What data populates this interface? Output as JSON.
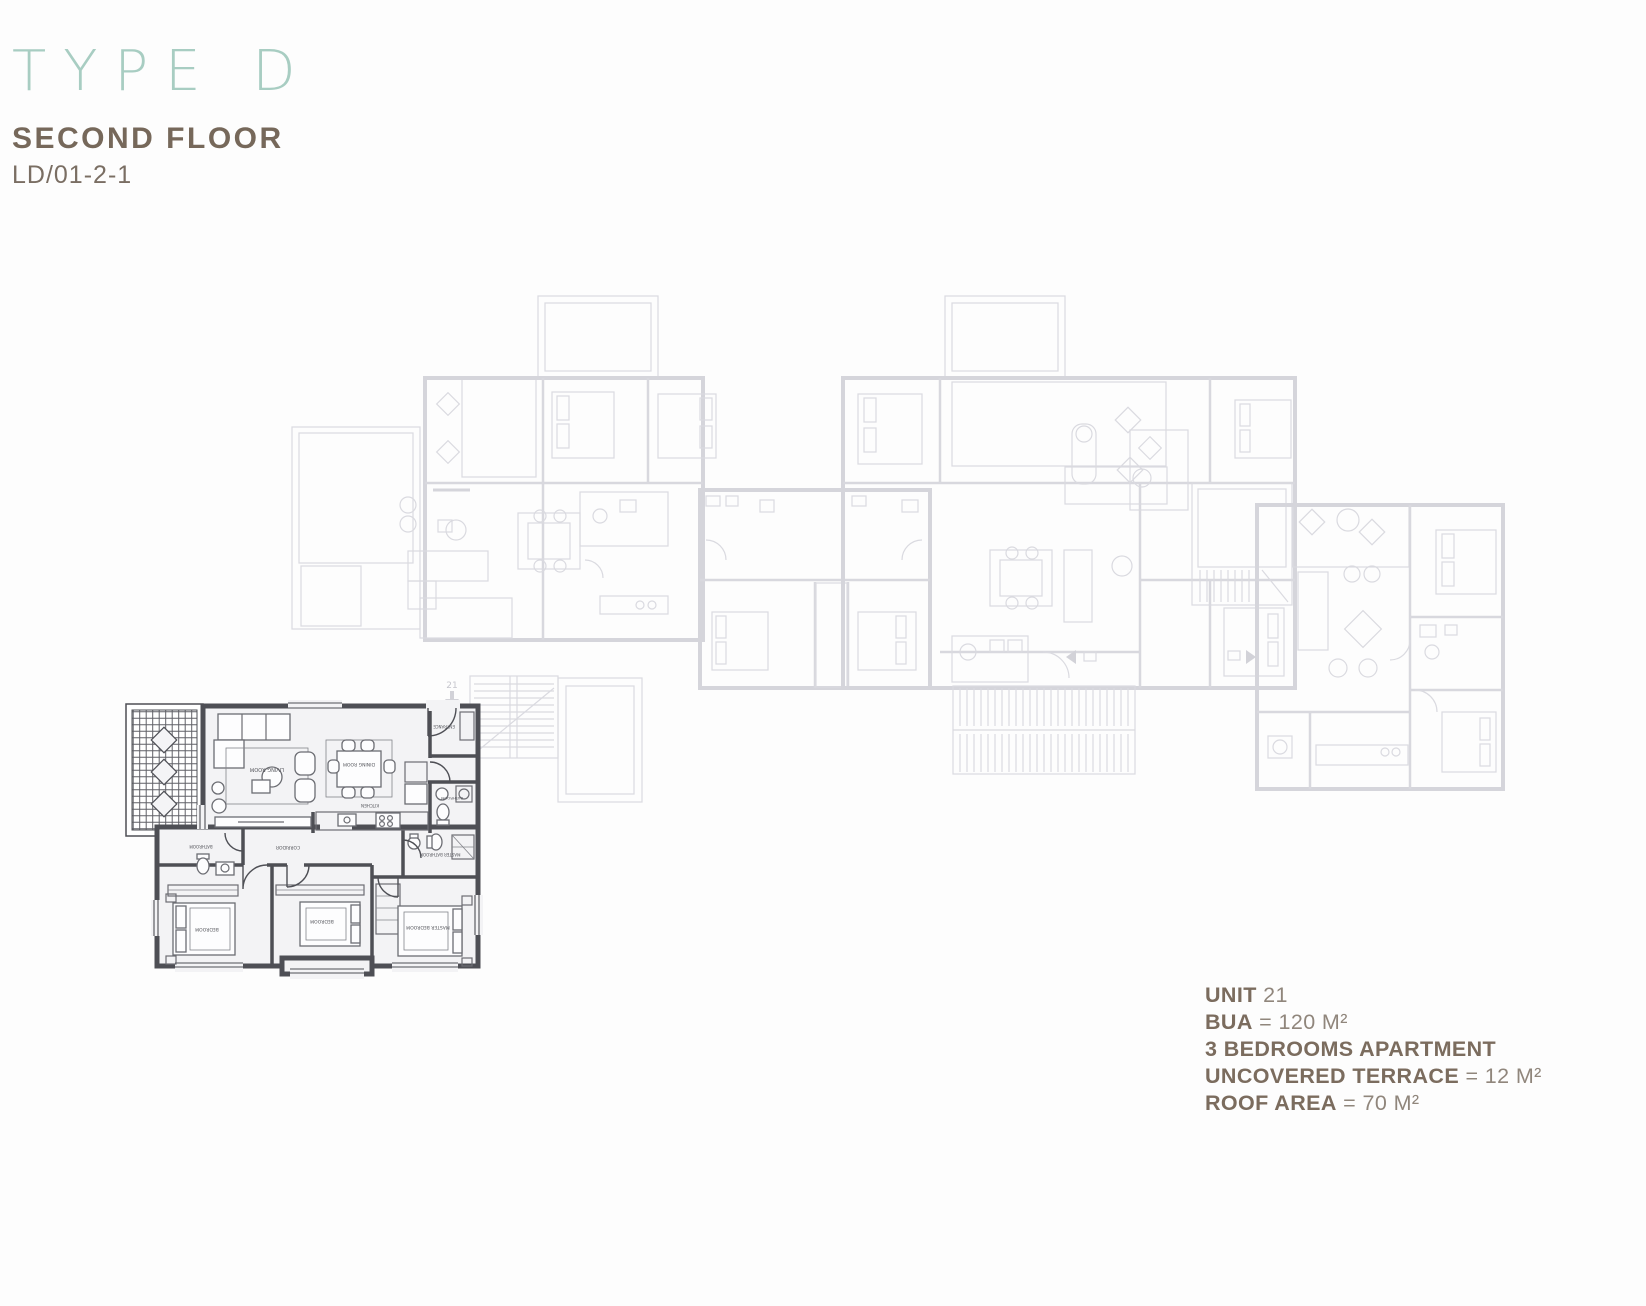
{
  "header": {
    "type_label": "TYPE D",
    "floor_label": "SECOND FLOOR",
    "code": "LD/01-2-1"
  },
  "unit_info": {
    "lines": [
      {
        "bold": "UNIT",
        "rest": " 21"
      },
      {
        "bold": "BUA",
        "rest": " = 120 M²"
      },
      {
        "bold": "3 BEDROOMS APARTMENT",
        "rest": ""
      },
      {
        "bold": "UNCOVERED TERRACE",
        "rest": " = 12 M²"
      },
      {
        "bold": "ROOF AREA",
        "rest": " = 70 M²"
      }
    ]
  },
  "plan": {
    "unit_marker": "21",
    "rooms": {
      "living": "LIVING ROOM",
      "dining": "DINING ROOM",
      "kitchen": "KITCHEN",
      "entrance": "ENTRANCE",
      "corridor": "CORRIDOR",
      "bathroom": "BATHROOM",
      "master_bathroom": "MASTER BATHROOM",
      "bedroom": "BEDROOM",
      "master_bedroom": "MASTER BEDROOM"
    }
  },
  "colors": {
    "teal": "#a8cdc2",
    "brown_dark": "#7b6c5e",
    "brown_light": "#90867c",
    "plan_faded": "#d5d5db",
    "plan_dark": "#4e4f55"
  }
}
